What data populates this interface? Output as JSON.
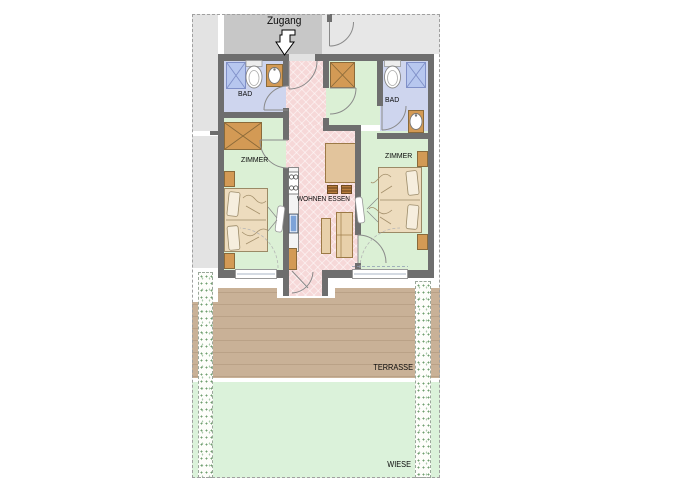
{
  "floorplan": {
    "labels": {
      "entrance": "Zugang",
      "bath_left": "BAD",
      "bath_right": "BAD",
      "bedroom_left": "ZIMMER",
      "bedroom_right": "ZIMMER",
      "living_dining": "WOHNEN ESSEN",
      "terrace": "TERRASSE",
      "lawn": "WIESE"
    },
    "fixtures": [
      "entrance-arrow",
      "corridor-door",
      "entrance-door",
      "shower",
      "toilet",
      "washbasin",
      "wardrobe",
      "double-bed",
      "nightstand",
      "radiator",
      "kitchenette",
      "stove",
      "kitchen-sink",
      "dining-table",
      "chair",
      "sofa-bench",
      "terrace-door",
      "window",
      "hedge"
    ],
    "colors": {
      "wall": "#6e6e6e",
      "corridor_floor": "#c7c7c7",
      "outside_area": "#e3e3e3",
      "bath_floor": "#ced5ee",
      "bedroom_floor": "#dbf0d5",
      "hall_living_floor": "#f6d8d8",
      "furniture_wood": "#d39a55",
      "bed_fabric": "#eddcbe",
      "shower_tray": "#b7c7ef",
      "kitchen_sink": "#7da3d8",
      "terrace_deck": "#c9b197",
      "lawn": "#dbf2da"
    }
  }
}
